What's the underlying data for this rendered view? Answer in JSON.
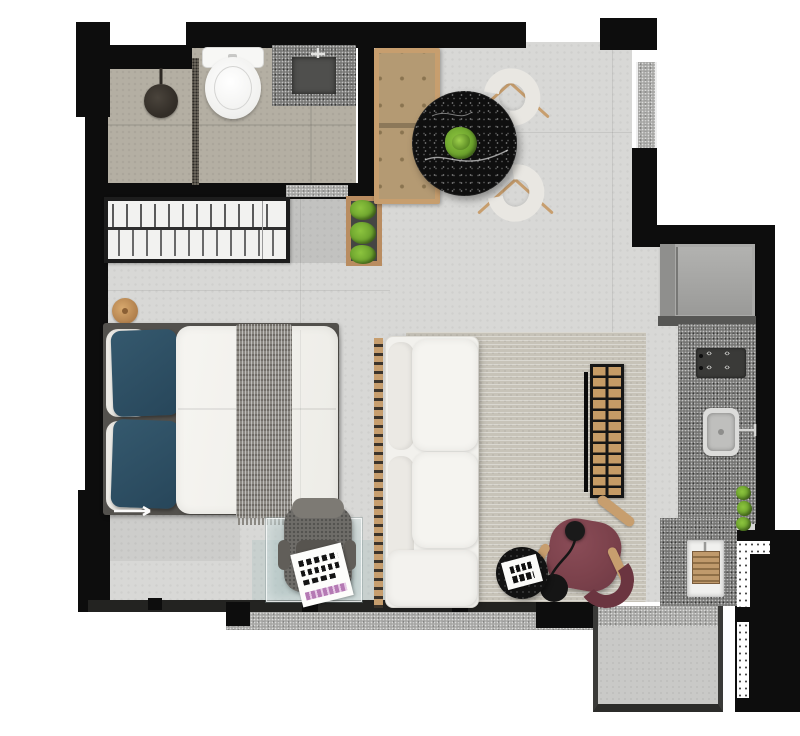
{
  "meta": {
    "description": "Top-down 3D rendered floor plan of a compact studio apartment",
    "canvas": {
      "width": 800,
      "height": 736
    },
    "visible_text": "none (book and magazine covers are illegible graphic marks)"
  },
  "palette": {
    "wall": "#0d0d0d",
    "concrete": "#d8d8d6",
    "tile": "#b4afa3",
    "granite": "#787876",
    "granite_light": "#a8a8a6",
    "wood": "#c79e6e",
    "bench_cushion": "#b49a73",
    "bench_button": "#8a7450",
    "teal": "#2d4f63",
    "duvet": "#f3f2ee",
    "throw": "#8b8882",
    "bed_frame": "#53514d",
    "rug": "#c7c3b8",
    "sofa": "#f2f1ed",
    "burgundy": "#7c424c",
    "burgundy_dark": "#6b3540",
    "black_furniture": "#0f0f0f",
    "plant": "#74a42f",
    "fridge": "#a6a6a4",
    "glass": "rgba(170,196,196,0.45)",
    "chair_gray": "#6f6d69",
    "balcony": "#c9c9c7",
    "tv_cell": "#c59b66"
  },
  "kitchen": {
    "burner_glyph": "‹›"
  },
  "rooms": {
    "bathroom": {
      "items": [
        "toilet",
        "granite-vanity-with-sink",
        "shower-head",
        "mosaic-drain-strip",
        "beige-tile-floor",
        "granite-door-threshold"
      ]
    },
    "closet_hall": {
      "items": [
        "wardrobe-with-hangers",
        "vertical-garden-planter",
        "wooden-stool",
        "entry-mat"
      ]
    },
    "bedroom": {
      "items": [
        "double-bed",
        "white-pillows",
        "teal-pillows",
        "white-duvet",
        "gray-knit-throw",
        "glass-desk",
        "gray-desk-chair",
        "open-magazine",
        "wood-slat-divider"
      ]
    },
    "living": {
      "items": [
        "white-sofa",
        "beige-rug",
        "tv-panel",
        "wood-grid-tv-rack",
        "burgundy-armchair",
        "burgundy-ottoman",
        "black-floor-lamp",
        "black-round-side-table",
        "white-book"
      ]
    },
    "dining": {
      "items": [
        "black-marble-round-table",
        "green-plant-centerpiece",
        "woven-chair",
        "woven-chair",
        "tufted-wood-bench"
      ]
    },
    "kitchen": {
      "items": [
        "refrigerator",
        "granite-counter",
        "cooktop-4-burners",
        "kitchen-sink",
        "herb-plants",
        "laundry-tank",
        "wooden-washboard",
        "window-counter-strip"
      ]
    },
    "balcony": {
      "items": [
        "concrete-floor",
        "granite-sill"
      ]
    }
  }
}
